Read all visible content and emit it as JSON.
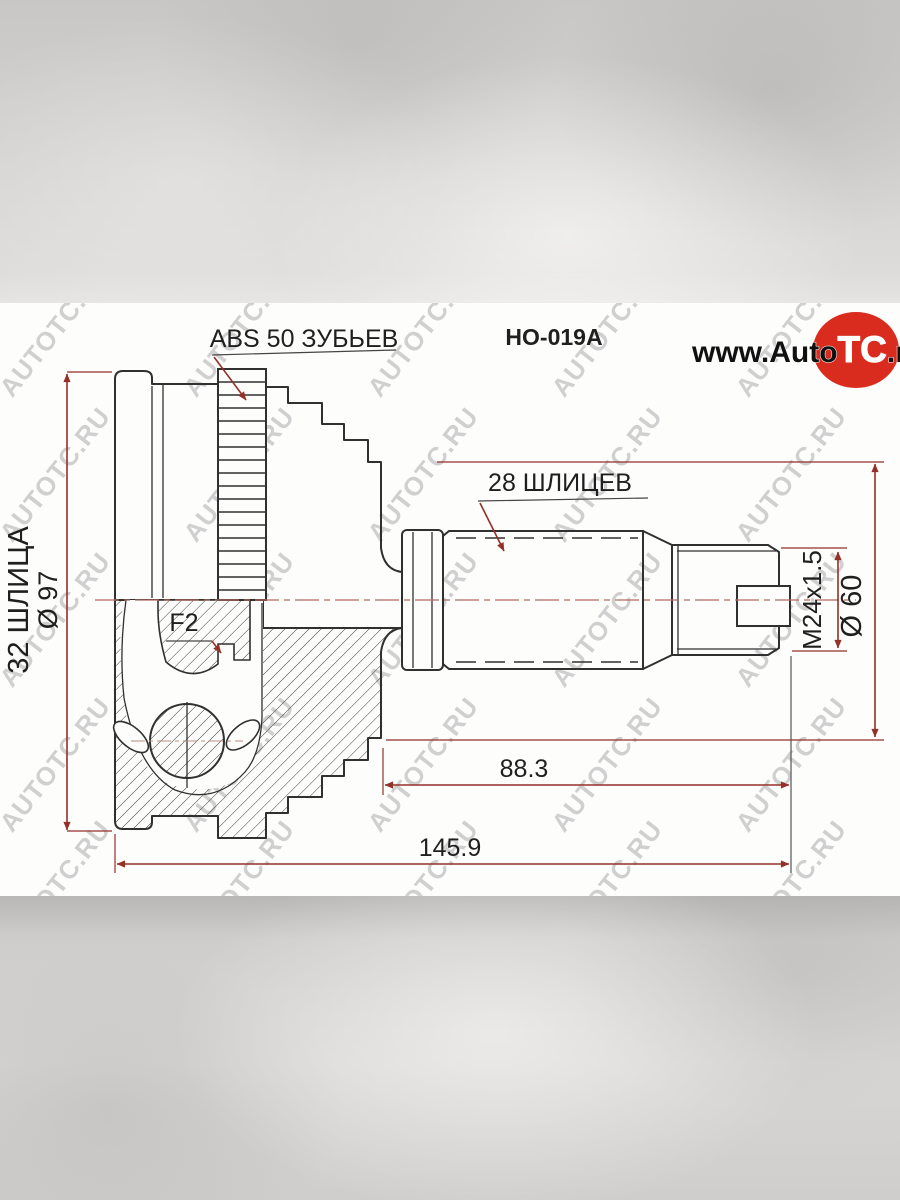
{
  "part_number": "HO-019A",
  "logo": {
    "www": "www.Auto",
    "tc": "TC",
    "ru": ".ru"
  },
  "watermark": {
    "text": "AUTOTC.RU"
  },
  "labels": {
    "abs_ring": "ABS 50 ЗУБЬЕВ",
    "outer_splines": "32 ШЛИЦА",
    "outer_diameter": "Ø 97",
    "groove": "F2",
    "shaft_splines": "28 ШЛИЦЕВ",
    "thread": "M24x1.5",
    "hub_diameter": "Ø 60",
    "shaft_length": "88.3",
    "total_length": "145.9"
  },
  "colors": {
    "dimension_red": "#943028",
    "drawing_line": "#303030",
    "logo_red": "#da2c1e",
    "watermark_gray": "#ababab"
  }
}
